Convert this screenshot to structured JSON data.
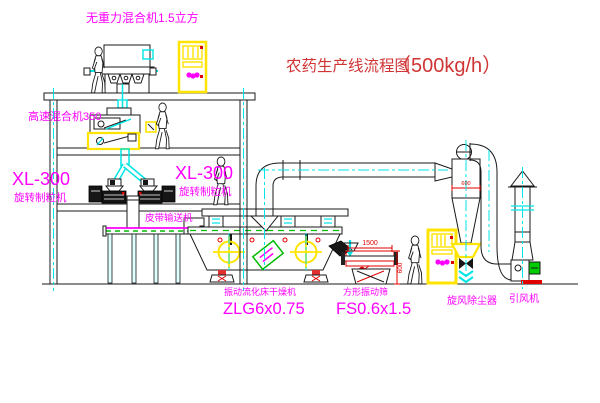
{
  "title": {
    "name": "农药生产线流程图",
    "capacity": "（500kg/h）"
  },
  "labels": {
    "gravity_mixer": "无重力混合机1.5立方",
    "high_speed_mixer": "高速混合机350",
    "xl300_left_model": "XL-300",
    "xl300_left_name": "旋转制粒机",
    "xl300_right_model": "XL-300",
    "xl300_right_name": "旋转制粒机",
    "belt_conveyor": "皮带输送机",
    "dryer_name": "振动流化床干燥机",
    "dryer_model": "ZLG6x0.75",
    "sieve_name": "方形振动筛",
    "sieve_model": "FS0.6x1.5",
    "cyclone": "旋风除尘器",
    "fan": "引风机"
  },
  "dimensions": {
    "sieve_length": "1500",
    "sieve_height": "600",
    "cyclone_diameter": "600"
  },
  "colors": {
    "label_magenta": "#FF00FF",
    "title_red": "#D03535",
    "line_black": "#1a1a1a",
    "centerline_cyan": "#00E5E5",
    "cabinet_yellow": "#FFE400",
    "accent_green": "#00BB00",
    "dimension_red": "#E00000"
  }
}
